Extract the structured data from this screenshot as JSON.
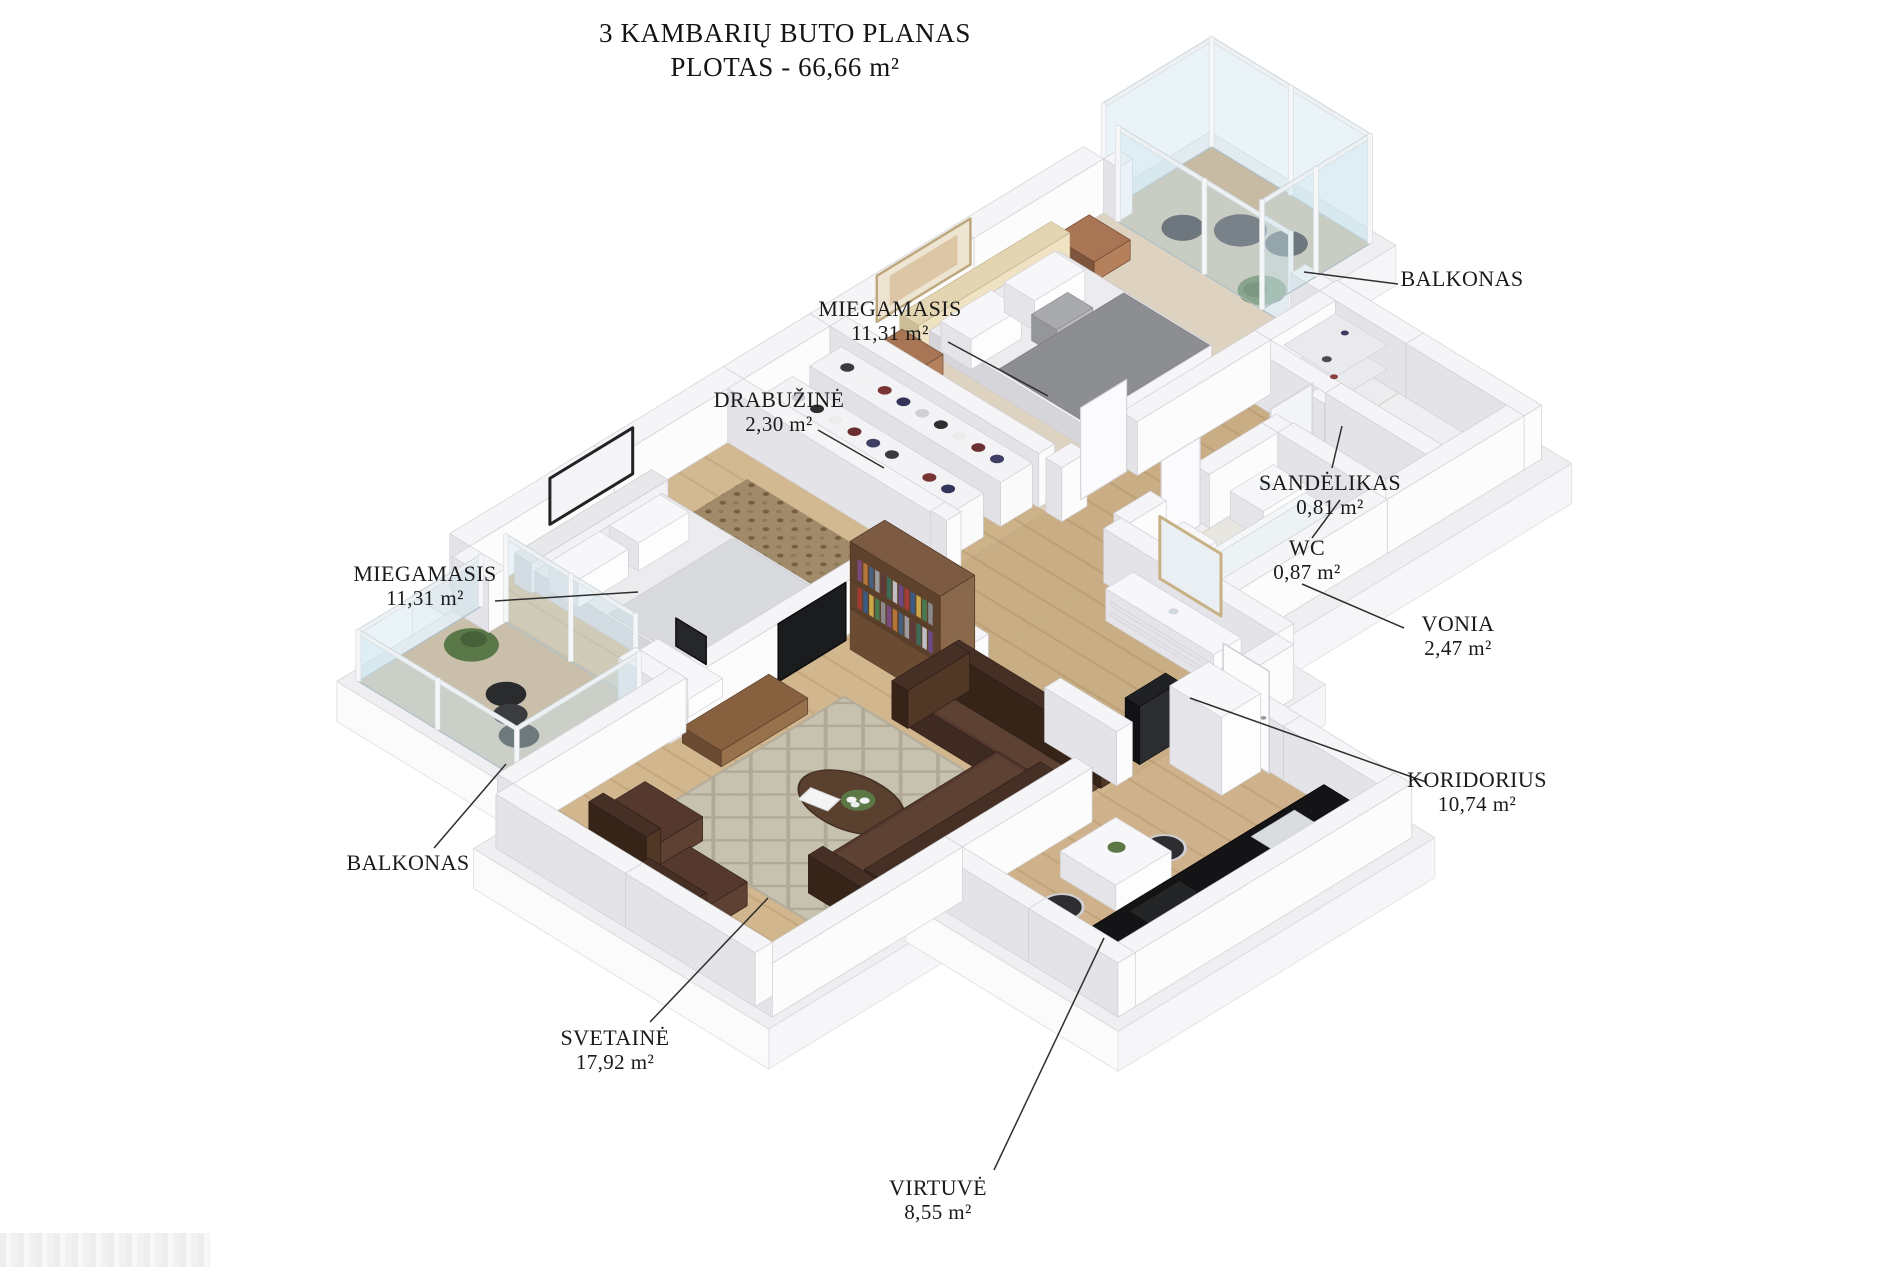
{
  "title": {
    "line1": "3 KAMBARIŲ BUTO PLANAS",
    "line2": "PLOTAS - 66,66 m²"
  },
  "labels": [
    {
      "id": "miegamasis-1",
      "name": "MIEGAMASIS",
      "area": "11,31 m²"
    },
    {
      "id": "drabuzine",
      "name": "DRABUŽINĖ",
      "area": "2,30 m²"
    },
    {
      "id": "balkonas-1",
      "name": "BALKONAS",
      "area": ""
    },
    {
      "id": "sandelikas",
      "name": "SANDĖLIKAS",
      "area": "0,81 m²"
    },
    {
      "id": "wc",
      "name": "WC",
      "area": "0,87 m²"
    },
    {
      "id": "vonia",
      "name": "VONIA",
      "area": "2,47 m²"
    },
    {
      "id": "koridorius",
      "name": "KORIDORIUS",
      "area": "10,74 m²"
    },
    {
      "id": "miegamasis-2",
      "name": "MIEGAMASIS",
      "area": "11,31 m²"
    },
    {
      "id": "balkonas-2",
      "name": "BALKONAS",
      "area": ""
    },
    {
      "id": "svetaine",
      "name": "SVETAINĖ",
      "area": "17,92 m²"
    },
    {
      "id": "virtuve",
      "name": "VIRTUVĖ",
      "area": "8,55 m²"
    }
  ],
  "palette": {
    "background": "#ffffff",
    "wall_top": "#f5f5f7",
    "wall_shade": "#e3e3e8",
    "wall_light": "#fcfcfd",
    "floor_wood": "#d2b68e",
    "floor_wood_dark": "#c9ad85",
    "carpet_beige": "#ded3c0",
    "tile_gray": "#e8e6e1",
    "sofa_brown": "#55392e",
    "walnut": "#7d5b42",
    "counter_black": "#141416",
    "glass": "#cfe0e8",
    "plant_green": "#5c7847",
    "leader_line": "#2f2f2f",
    "text": "#1a1a1a"
  }
}
